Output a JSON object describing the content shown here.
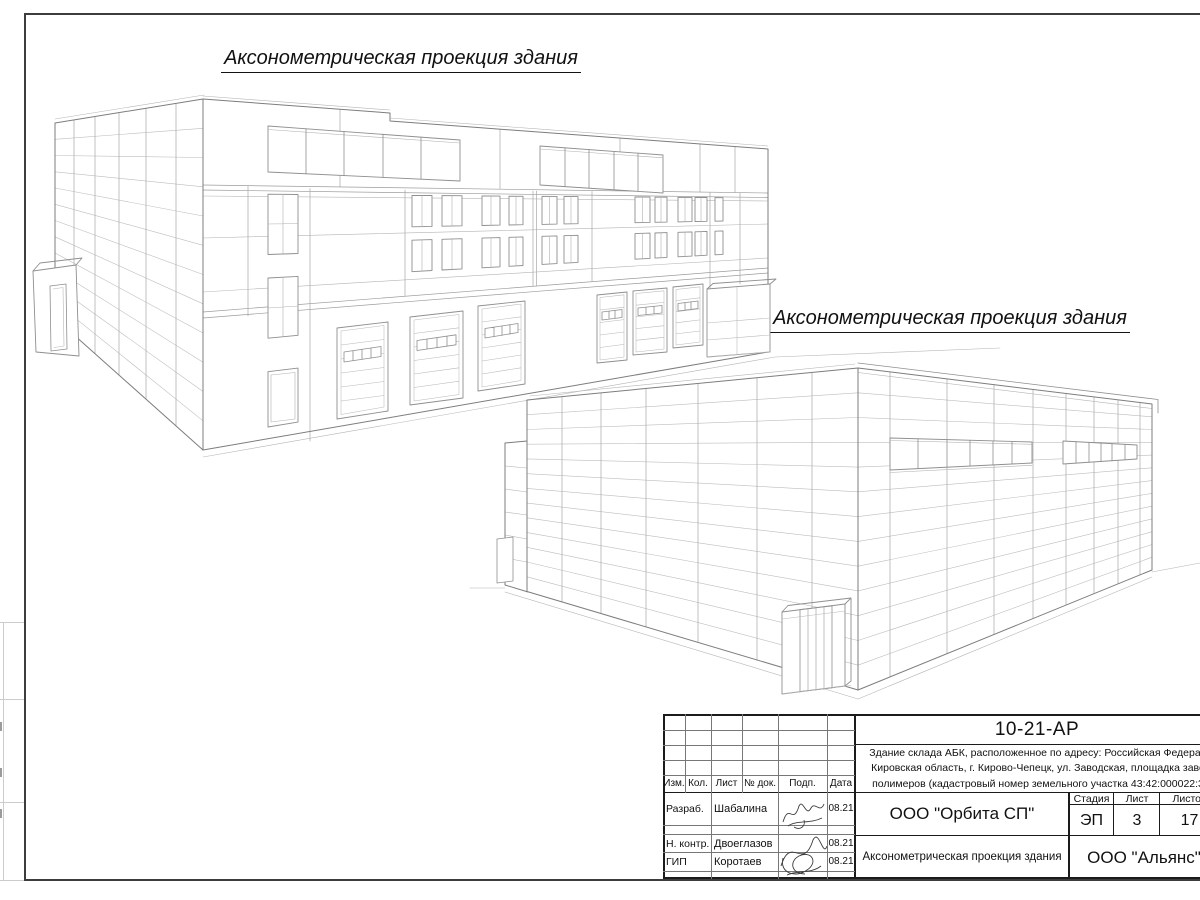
{
  "titles": {
    "view1": "Аксонометрическая проекция здания",
    "view2": "Аксонометрическая проекция здания"
  },
  "stamp": {
    "doc_code": "10-21-АР",
    "description_line1": "Здание склада АБК, расположенное по адресу: Российская Федерац",
    "description_line2": "Кировская область, г. Кирово-Чепецк, ул. Заводская, площадка заво",
    "description_line3": "полимеров (кадастровый номер земельного участка 43:42:000022:3",
    "col_izm": "Изм.",
    "col_kol": "Кол.",
    "col_list": "Лист",
    "col_doc": "№ док.",
    "col_podp": "Подп.",
    "col_data": "Дата",
    "row1_role": "Разраб.",
    "row1_name": "Шабалина",
    "row1_date": "08.21",
    "row2_role": "Н. контр.",
    "row2_name": "Двоеглазов",
    "row2_date": "08.21",
    "row3_role": "ГИП",
    "row3_name": "Коротаев",
    "row3_date": "08.21",
    "designer_company": "ООО \"Орбита СП\"",
    "stage_label": "Стадия",
    "sheet_label": "Лист",
    "sheets_label": "Листов",
    "stage_value": "ЭП",
    "sheet_value": "3",
    "sheets_value": "17",
    "sheet_title": "Аксонометрическая проекция здания",
    "client_company": "ООО \"Альянс\""
  },
  "colors": {
    "outline": "#7d7d7d",
    "panel_line": "#bdbdbd",
    "seam_line": "#a9a9a9",
    "window_frame": "#8f8f8f",
    "frame_border": "#3d3d3d"
  }
}
